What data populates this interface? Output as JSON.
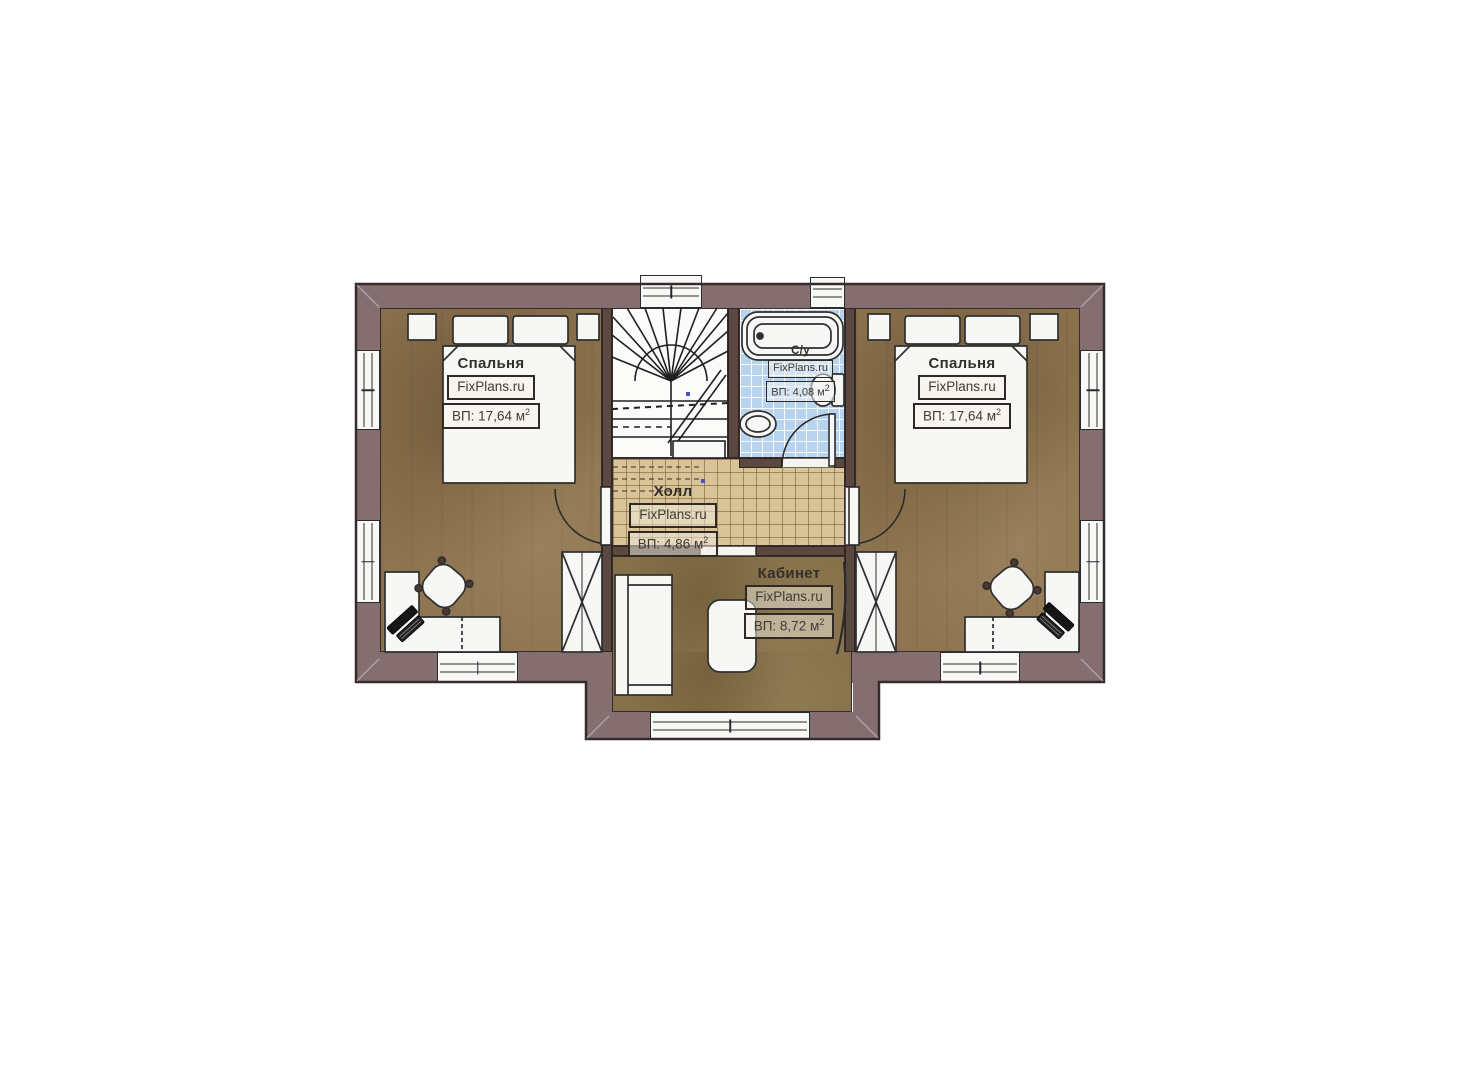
{
  "page": {
    "background": "#ffffff"
  },
  "plan": {
    "type": "floor-plan",
    "brand_watermark": "FixPlans.ru",
    "rooms": [
      {
        "id": "bedroom-left",
        "name": "Спальня",
        "watermark": "FixPlans.ru",
        "area": "ВП: 17,64 м",
        "area_sup": "2"
      },
      {
        "id": "bedroom-right",
        "name": "Спальня",
        "watermark": "FixPlans.ru",
        "area": "ВП: 17,64 м",
        "area_sup": "2"
      },
      {
        "id": "bathroom",
        "name": "С/у",
        "watermark": "FixPlans.ru",
        "area": "ВП: 4,08 м",
        "area_sup": "2"
      },
      {
        "id": "hall",
        "name": "Холл",
        "watermark": "FixPlans.ru",
        "area": "ВП: 4,86 м",
        "area_sup": "2"
      },
      {
        "id": "office",
        "name": "Кабинет",
        "watermark": "FixPlans.ru",
        "area": "ВП: 8,72 м",
        "area_sup": "2"
      }
    ],
    "colors": {
      "wall": "#846e70",
      "wall_partition": "#5b4840",
      "floor_bedroom": "#8e7450",
      "floor_office": "#857049",
      "tile_hall": "#d9c499",
      "tile_bath": "#b7d3ee",
      "line": "#2b2b2b",
      "furniture": "#f7f7f5",
      "dot_accent": "#4653c8"
    }
  }
}
